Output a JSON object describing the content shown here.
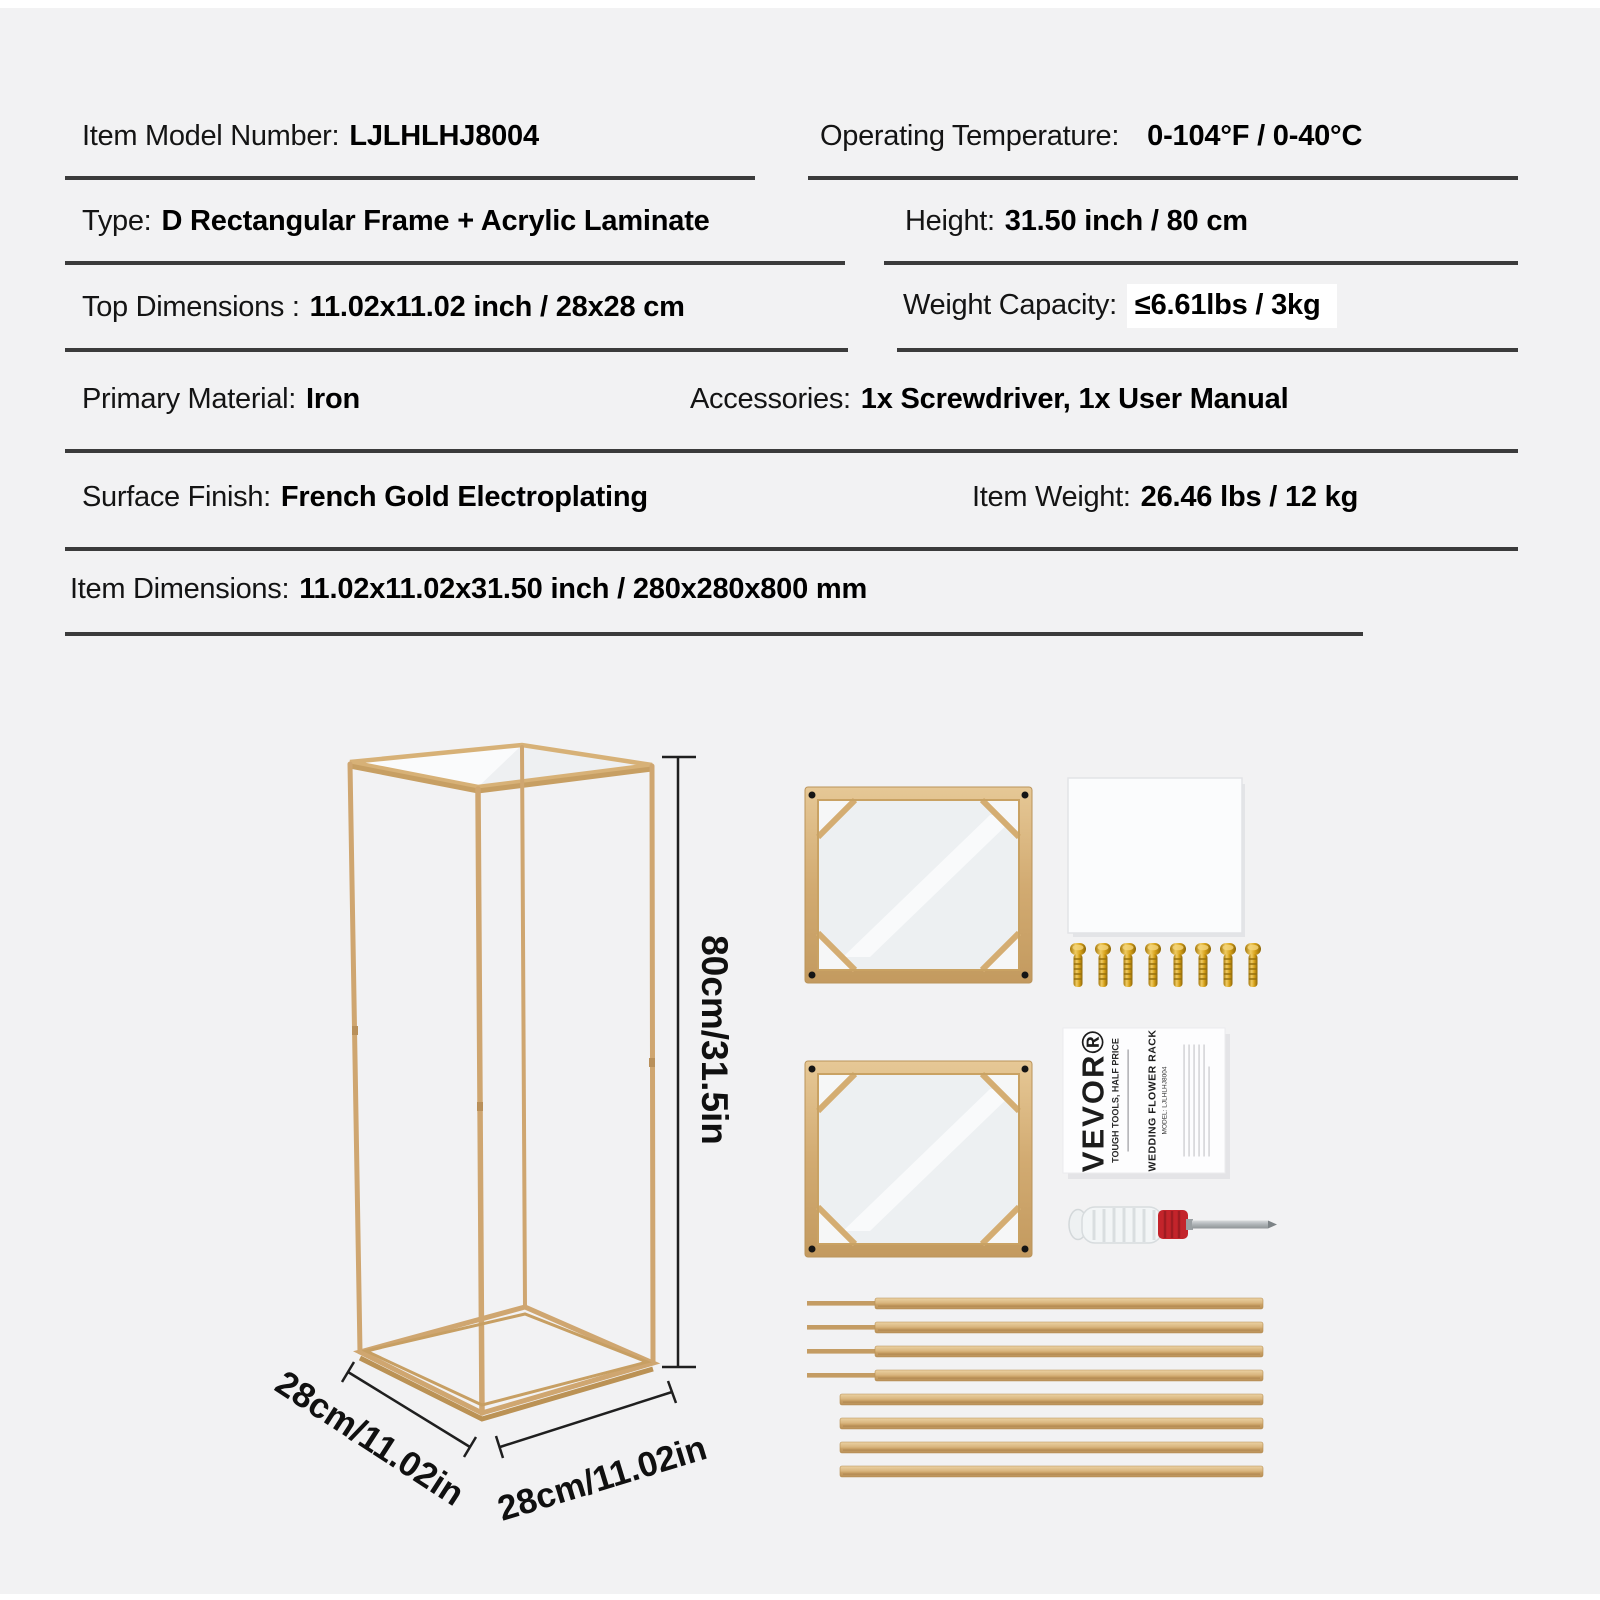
{
  "colors": {
    "background": "#f2f2f3",
    "divider": "#3b3b3b",
    "text": "#141414",
    "gold": "#cfa670",
    "highlight_background": "#ffffff",
    "screwdriver_red": "#c3242b"
  },
  "spec_table": {
    "rows": [
      {
        "left": {
          "label": "Item Model Number:",
          "value": "LJLHLHJ8004"
        },
        "right": {
          "label": "Operating Temperature:",
          "value": "0-104°F / 0-40°C"
        }
      },
      {
        "left": {
          "label": "Type:",
          "value": "D Rectangular Frame + Acrylic Laminate"
        },
        "right": {
          "label": "Height:",
          "value": "31.50 inch / 80 cm"
        }
      },
      {
        "left": {
          "label": "Top Dimensions :",
          "value": "11.02x11.02 inch / 28x28 cm"
        },
        "right": {
          "label": "Weight Capacity:",
          "value": "≤6.61lbs / 3kg",
          "highlighted": true
        }
      },
      {
        "left": {
          "label": "Primary Material:",
          "value": "Iron"
        },
        "right": {
          "label": "Accessories:",
          "value": "1x Screwdriver, 1x User Manual"
        }
      },
      {
        "left": {
          "label": "Surface Finish:",
          "value": "French Gold Electroplating"
        },
        "right": {
          "label": "Item Weight:",
          "value": "26.46 lbs / 12 kg"
        }
      },
      {
        "left": {
          "label": "Item Dimensions:",
          "value": "11.02x11.02x31.50 inch / 280x280x800 mm"
        }
      }
    ]
  },
  "illustration": {
    "height_label": "80cm/31.5in",
    "base_left_label": "28cm/11.02in",
    "base_right_label": "28cm/11.02in",
    "parts": {
      "frame_panels": 2,
      "acrylic_sheets": 1,
      "screws": 8,
      "user_manual": 1,
      "screwdriver": 1,
      "rods": 8
    }
  },
  "manual": {
    "brand": "VEVOR®",
    "tagline": "TOUGH TOOLS, HALF PRICE",
    "title": "WEDDING FLOWER RACK",
    "model_line": "MODEL: LJLHLHJ8004"
  }
}
